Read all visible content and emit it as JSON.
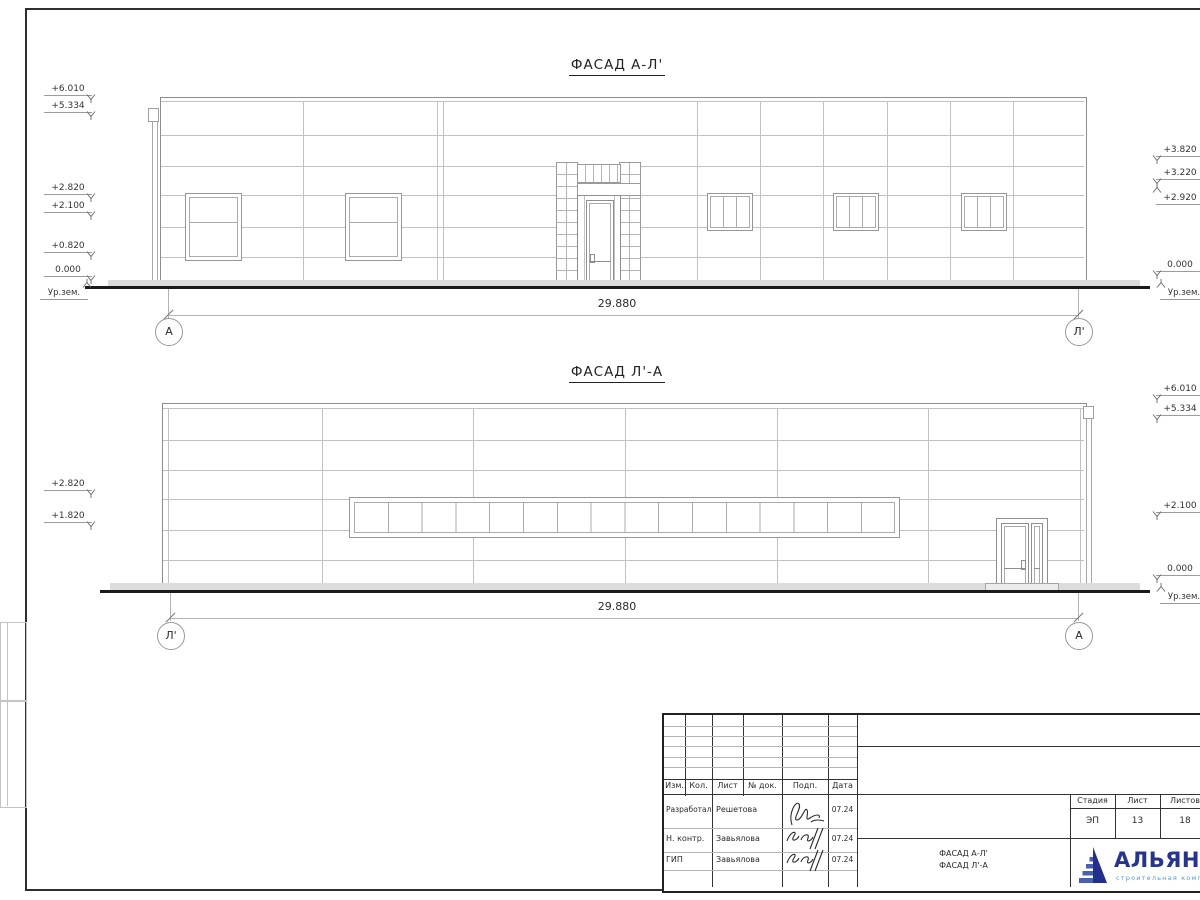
{
  "sheet": {
    "facade_top": {
      "title": "ФАСАД А-Л'",
      "dimension": "29.880",
      "axis_left": "А",
      "axis_right": "Л'",
      "elev_left": [
        "+6.010",
        "+5.334",
        "+2.820",
        "+2.100",
        "+0.820",
        "0.000"
      ],
      "ground_left": "Ур.зем.",
      "elev_right": [
        "+3.820",
        "+3.220",
        "+2.920",
        "0.000"
      ],
      "ground_right": "Ур.зем."
    },
    "facade_bottom": {
      "title": "ФАСАД Л'-А",
      "dimension": "29.880",
      "axis_left": "Л'",
      "axis_right": "А",
      "elev_left": [
        "+2.820",
        "+1.820"
      ],
      "elev_right": [
        "+6.010",
        "+5.334",
        "+2.100",
        "0.000"
      ],
      "ground_right": "Ур.зем."
    },
    "title_block": {
      "headers": [
        "Изм.",
        "Кол.",
        "Лист",
        "№ док.",
        "Подп.",
        "Дата"
      ],
      "rows": [
        {
          "role": "Разработал",
          "name": "Решетова",
          "date": "07.24"
        },
        {
          "role": "Н. контр.",
          "name": "Завьялова",
          "date": "07.24"
        },
        {
          "role": "ГИП",
          "name": "Завьялова",
          "date": "07.24"
        }
      ],
      "stage_label": "Стадия",
      "sheet_label": "Лист",
      "sheets_label": "Листов",
      "stage": "ЭП",
      "sheet": "13",
      "sheets": "18",
      "doc_title_line1": "ФАСАД А-Л'",
      "doc_title_line2": "ФАСАД Л'-А",
      "logo_name": "АЛЬЯНС",
      "logo_tagline": "строительная компания",
      "logo_color_dark": "#27348b",
      "logo_color_light": "#5b9bd5"
    }
  }
}
